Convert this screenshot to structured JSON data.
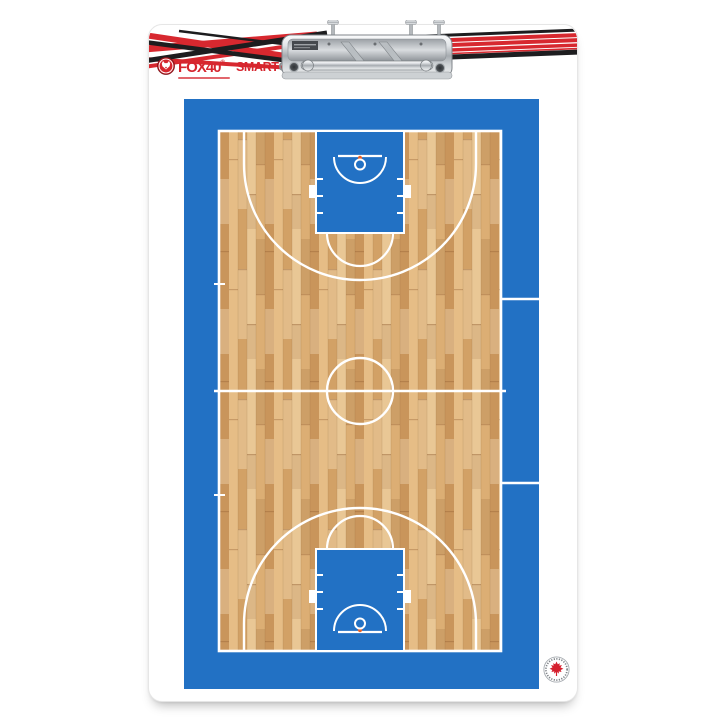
{
  "product": {
    "description": "Fox 40 SmartCoach dry-erase basketball coaching clipboard, full-court top view",
    "made_in_canada_badge": "maple-leaf seal, bottom right of court"
  },
  "branding": {
    "fox40_text": "FOX40",
    "fox40_registered": "®",
    "smart_text": "SMART",
    "coach_text": "COACH",
    "coach_registered": "®"
  },
  "court": {
    "view": "full basketball court, portrait orientation, wood floor with blue painted apron and keys",
    "markings": [
      "baseline top",
      "baseline bottom",
      "sidelines",
      "half-court line with sideline nubs",
      "center circle",
      "free-throw lane (key) top",
      "free-throw lane (key) bottom",
      "free-throw semicircle top",
      "free-throw semicircle bottom",
      "three-point arc top",
      "three-point arc bottom",
      "backboard line top",
      "backboard line bottom",
      "rim circle top",
      "rim circle bottom",
      "orange rim-mount dot top",
      "orange rim-mount dot bottom",
      "restricted-area arc top",
      "restricted-area arc bottom",
      "lane hash marks and blocks",
      "throw-in tick marks on left sideline",
      "coach-box lines across right apron"
    ]
  },
  "colors": {
    "court_blue": "#2271c4",
    "line_white": "#ffffff",
    "wood_base": "#ddb27c",
    "stripe_red": "#d7282f",
    "stripe_black": "#1d1d1f",
    "fox40_red": "#d6252e",
    "coach_gray": "#8b8e90",
    "rim_orange": "#e8622a",
    "maple_red": "#d5202e",
    "clip_chrome": "#c9ccd0"
  }
}
